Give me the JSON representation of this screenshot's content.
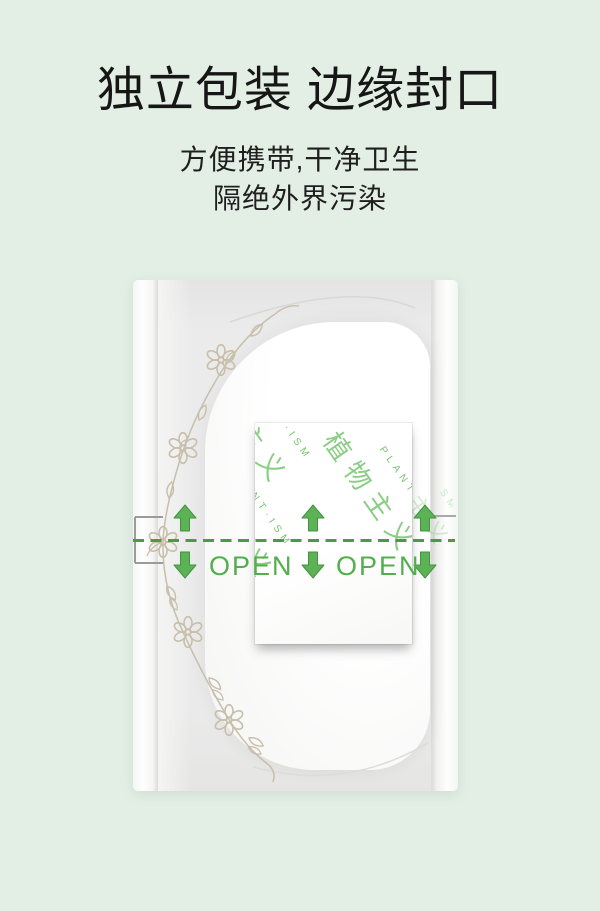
{
  "page": {
    "background_color": "#e3efe5"
  },
  "header": {
    "title": "独立包装 边缘封口",
    "subtitle_line1": "方便携带,干净卫生",
    "subtitle_line2": "隔绝外界污染"
  },
  "package": {
    "open_label_left": "OPEN",
    "open_label_right": "OPEN",
    "brand_pattern": {
      "cn": "植物主义",
      "en": "PLANT·ISM"
    },
    "colors": {
      "open_green": "#53ae4d",
      "dash_green": "#4a9a48",
      "arrow_green": "#5cb355",
      "pattern_green": "#6fc167",
      "vine_beige": "#c8bfab",
      "wrapper_gray": "#eaeaea"
    }
  }
}
